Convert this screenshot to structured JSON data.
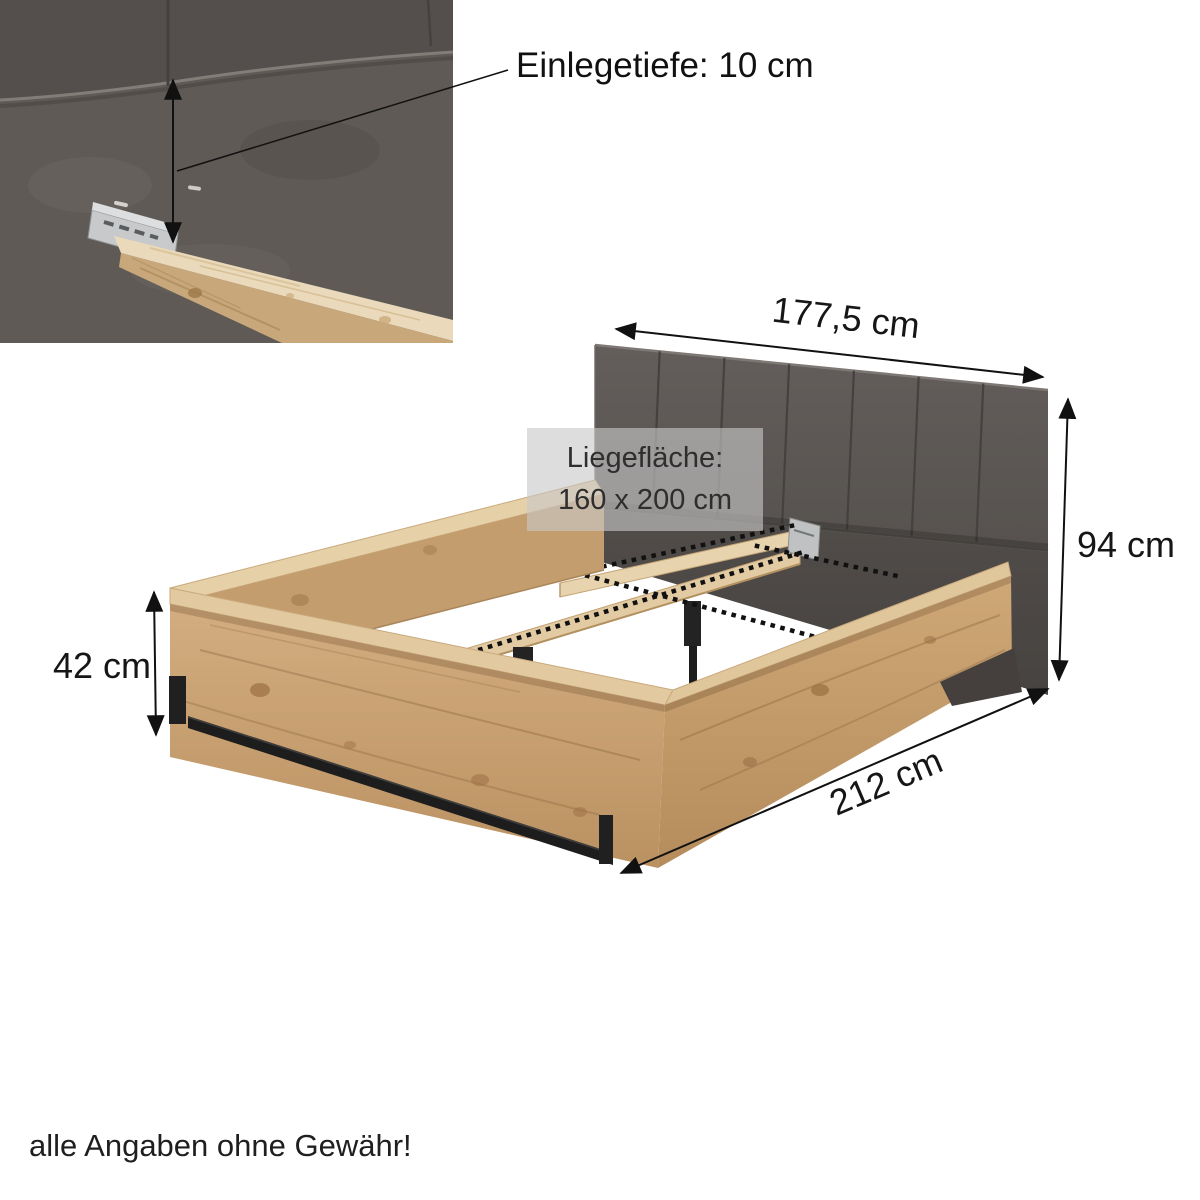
{
  "inset": {
    "depth_label": "Einlegetiefe: 10 cm"
  },
  "dimensions": {
    "headboard_width": "177,5 cm",
    "headboard_height": "94 cm",
    "frame_height": "42 cm",
    "total_length": "212 cm"
  },
  "lying_surface": {
    "title": "Liegefläche:",
    "size": "160 x 200 cm"
  },
  "footer": {
    "disclaimer": "alle Angaben ohne Gewähr!"
  },
  "colors": {
    "wood": "#c9a174",
    "wood_light": "#e6d0a8",
    "upholstery_dark": "#5b5754",
    "metal_black": "#1f1f1f",
    "bracket_metal": "#c7c9ca",
    "overlay_box": "rgba(200,200,200,0.62)",
    "text": "#161616",
    "background": "#ffffff"
  }
}
